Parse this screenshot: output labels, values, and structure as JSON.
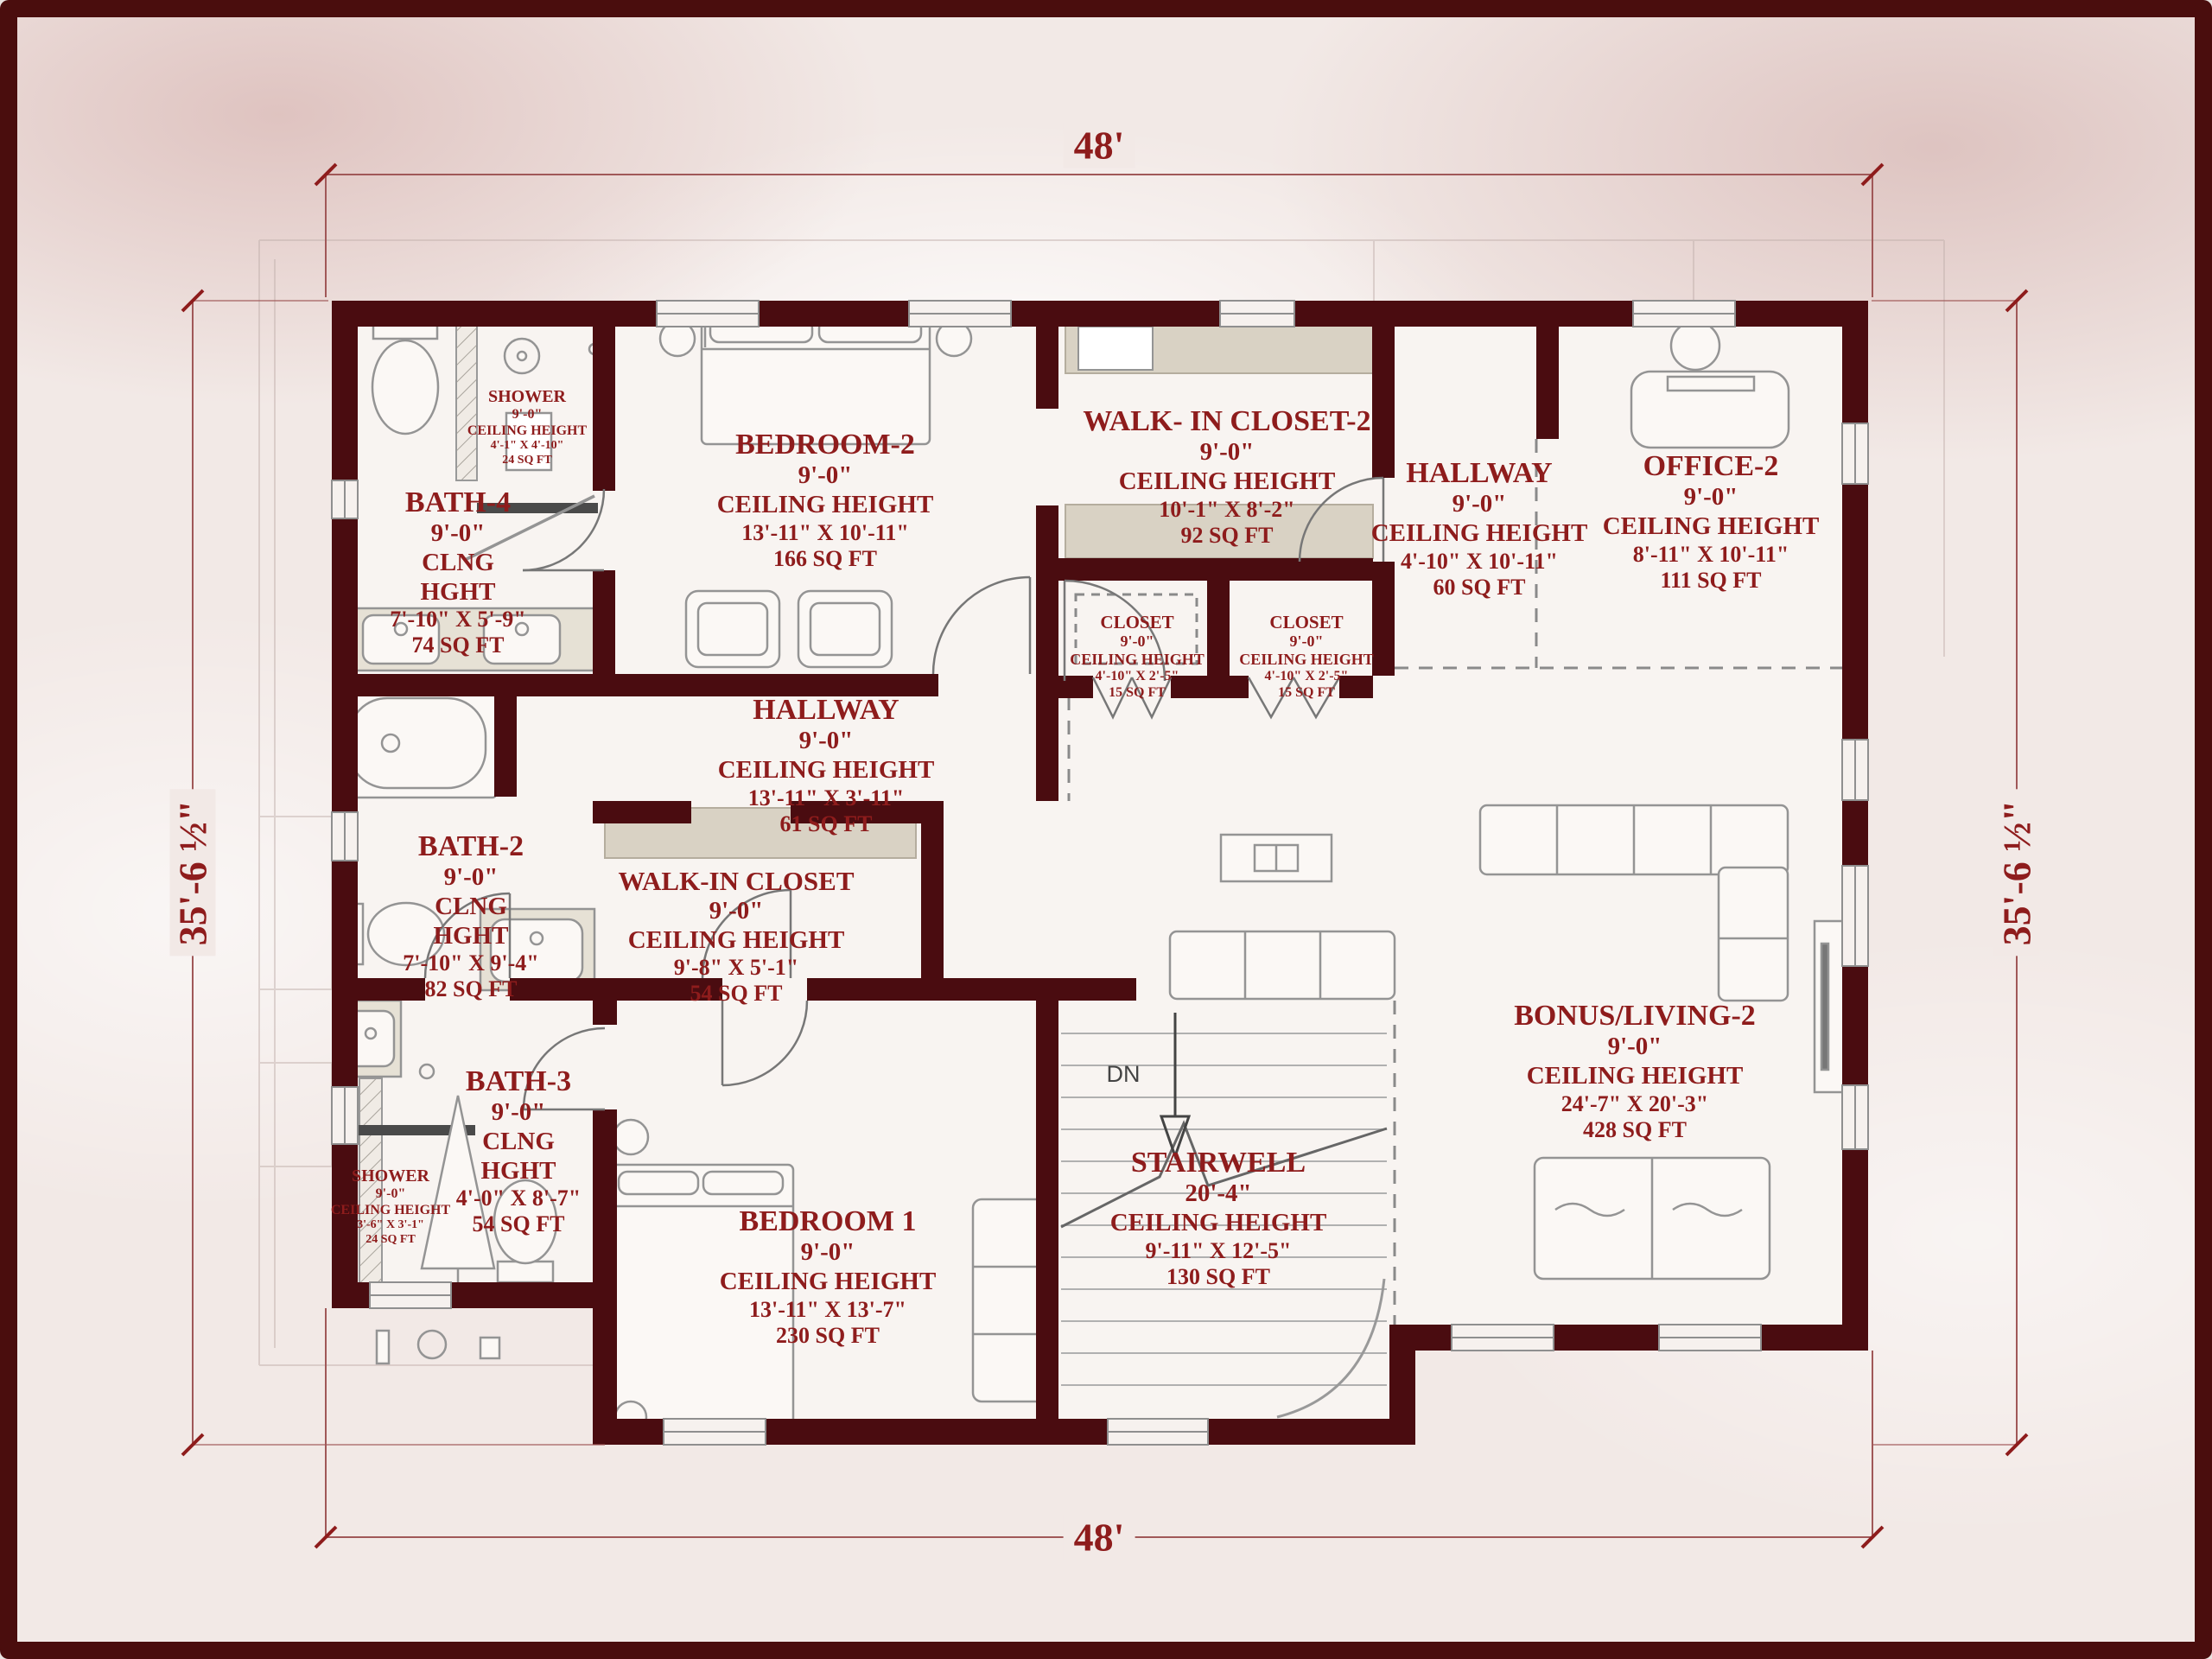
{
  "colors": {
    "wall": "#4a0c10",
    "frame": "#4a0d0d",
    "label_text": "#8e1c1c",
    "dimension_text": "#8e1c1c",
    "background": "#f2e9e6"
  },
  "dimensions": {
    "top": "48'",
    "bottom": "48'",
    "left": "35'-6 ½\"",
    "right": "35'-6 ½\""
  },
  "stairs": {
    "down_label": "DN"
  },
  "rooms": {
    "shower_top": {
      "name": "SHOWER",
      "lines": [
        "9'-0\"",
        "CEILING HEIGHT",
        "4'-1\" X 4'-10\"",
        "24 SQ FT"
      ]
    },
    "bath4": {
      "name": "BATH-4",
      "lines": [
        "9'-0\"",
        "CLNG",
        "HGHT",
        "7'-10\" X 5'-9\"",
        "74 SQ FT"
      ]
    },
    "bedroom2": {
      "name": "BEDROOM-2",
      "lines": [
        "9'-0\"",
        "CEILING HEIGHT",
        "13'-11\" X 10'-11\"",
        "166 SQ FT"
      ]
    },
    "walk_in_closet2": {
      "name": "WALK- IN CLOSET-2",
      "lines": [
        "9'-0\"",
        "CEILING HEIGHT",
        "10'-1\" X 8'-2\"",
        "92 SQ FT"
      ]
    },
    "hallway_upper": {
      "name": "HALLWAY",
      "lines": [
        "9'-0\"",
        "CEILING HEIGHT",
        "4'-10\" X 10'-11\"",
        "60 SQ FT"
      ]
    },
    "office2": {
      "name": "OFFICE-2",
      "lines": [
        "9'-0\"",
        "CEILING HEIGHT",
        "8'-11\" X 10'-11\"",
        "111 SQ FT"
      ]
    },
    "closet_left": {
      "name": "CLOSET",
      "lines": [
        "9'-0\"",
        "CEILING HEIGHT",
        "4'-10\" X 2'-5\"",
        "15 SQ FT"
      ]
    },
    "closet_right": {
      "name": "CLOSET",
      "lines": [
        "9'-0\"",
        "CEILING HEIGHT",
        "4'-10\" X 2'-5\"",
        "15 SQ FT"
      ]
    },
    "hallway_main": {
      "name": "HALLWAY",
      "lines": [
        "9'-0\"",
        "CEILING HEIGHT",
        "13'-11\" X 3'-11\"",
        "61 SQ FT"
      ]
    },
    "bath2": {
      "name": "BATH-2",
      "lines": [
        "9'-0\"",
        "CLNG",
        "HGHT",
        "7'-10\" X 9'-4\"",
        "82 SQ FT"
      ]
    },
    "walk_in_closet1": {
      "name": "WALK-IN CLOSET",
      "lines": [
        "9'-0\"",
        "CEILING HEIGHT",
        "9'-8\" X 5'-1\"",
        "54 SQ FT"
      ]
    },
    "bath3": {
      "name": "BATH-3",
      "lines": [
        "9'-0\"",
        "CLNG",
        "HGHT",
        "4'-0\" X 8'-7\"",
        "54 SQ FT"
      ]
    },
    "shower_bottom": {
      "name": "SHOWER",
      "lines": [
        "9'-0\"",
        "CEILING HEIGHT",
        "3'-6\" X 3'-1\"",
        "24 SQ FT"
      ]
    },
    "bedroom1": {
      "name": "BEDROOM 1",
      "lines": [
        "9'-0\"",
        "CEILING HEIGHT",
        "13'-11\" X 13'-7\"",
        "230 SQ FT"
      ]
    },
    "stairwell": {
      "name": "STAIRWELL",
      "lines": [
        "20'-4\"",
        "CEILING HEIGHT",
        "9'-11\" X 12'-5\"",
        "130 SQ FT"
      ]
    },
    "bonus_living2": {
      "name": "BONUS/LIVING-2",
      "lines": [
        "9'-0\"",
        "CEILING HEIGHT",
        "24'-7\" X 20'-3\"",
        "428 SQ FT"
      ]
    }
  }
}
